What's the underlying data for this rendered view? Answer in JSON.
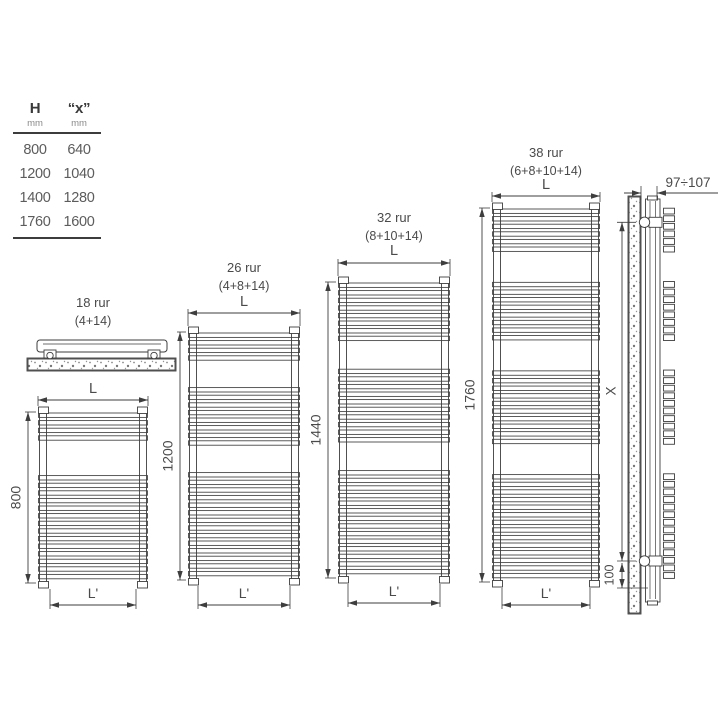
{
  "table": {
    "columns": [
      {
        "header": "H",
        "unit": "mm"
      },
      {
        "header": "“x”",
        "unit": "mm"
      }
    ],
    "rows": [
      {
        "h": "800",
        "x": "640"
      },
      {
        "h": "1200",
        "x": "1040"
      },
      {
        "h": "1400",
        "x": "1280"
      },
      {
        "h": "1760",
        "x": "1600"
      }
    ]
  },
  "radiators": [
    {
      "title": "18 rur",
      "formula": "(4+14)",
      "tube_groups": [
        4,
        14
      ],
      "height_label": "800",
      "width_label": "L",
      "inner_width_label": "L'"
    },
    {
      "title": "26 rur",
      "formula": "(4+8+14)",
      "tube_groups": [
        4,
        8,
        14
      ],
      "height_label": "1200",
      "width_label": "L",
      "inner_width_label": "L'"
    },
    {
      "title": "32 rur",
      "formula": "(8+10+14)",
      "tube_groups": [
        8,
        10,
        14
      ],
      "height_label": "1440",
      "width_label": "L",
      "inner_width_label": "L'"
    },
    {
      "title": "38 rur",
      "formula": "(6+8+10+14)",
      "tube_groups": [
        6,
        8,
        10,
        14
      ],
      "height_label": "1760",
      "width_label": "L",
      "inner_width_label": "L'"
    }
  ],
  "side_view": {
    "wall_distance_label": "97÷107",
    "height_label": "X",
    "bottom_offset_label": "100"
  },
  "colors": {
    "line": "#3e3e3e",
    "text": "#4a4a4a",
    "speckle": "#8b8b8b"
  }
}
